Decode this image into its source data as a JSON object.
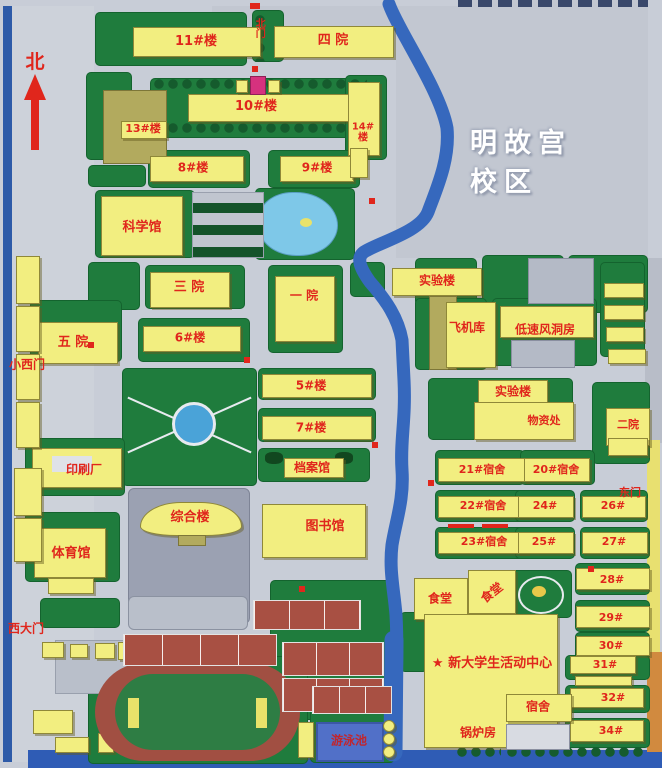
{
  "title": "明故宫校区",
  "compass": {
    "north": "北"
  },
  "gates": {
    "north_gate": "北门",
    "small_west_gate": "小西门",
    "west_main_gate": "西大门",
    "east_gate": "东门"
  },
  "buildings": {
    "b11": "11#楼",
    "b10": "10#楼",
    "b13": "13#楼",
    "b14_line1": "14#",
    "b14_line2": "楼",
    "b8": "8#楼",
    "b9": "9#楼",
    "b6": "6#楼",
    "b5": "5#楼",
    "b7": "7#楼",
    "siyuan": "四 院",
    "sanyuan": "三 院",
    "yiyuan": "一 院",
    "wuyuan": "五 院",
    "eryuan": "二院",
    "kexueguan": "科学馆",
    "shiyanlou_north": "实验楼",
    "feijiku": "飞机库",
    "fengdongfang": "低速风洞房",
    "shiyanlou_south": "实验楼",
    "wuzichu": "物资处",
    "danganguan": "档案馆",
    "yinshuachang": "印刷厂",
    "zonghelou": "综合楼",
    "tiyuguan": "体育馆",
    "tushuguan": "图书馆",
    "shitang_west": "食堂",
    "shitang_east": "食堂",
    "dorm21": "21#宿舍",
    "dorm20": "20#宿舍",
    "dorm22": "22#宿舍",
    "dorm23": "23#宿舍",
    "dorm24": "24#",
    "dorm25": "25#",
    "dorm26": "26#",
    "dorm27": "27#",
    "dorm28": "28#",
    "dorm29": "29#",
    "dorm30": "30#",
    "dorm31": "31#",
    "dorm32": "32#",
    "dorm34": "34#",
    "sushe": "宿舍",
    "guolufang": "锅炉房",
    "activity_center": "★ 新大学生活动中心",
    "youyongchi": "游泳池"
  },
  "colors": {
    "building_yellow": "#f2ee80",
    "lawn_green": "#1f7c3d",
    "label_red": "#e0261c",
    "river_blue": "#3668bd",
    "track_red": "#a14f42"
  }
}
